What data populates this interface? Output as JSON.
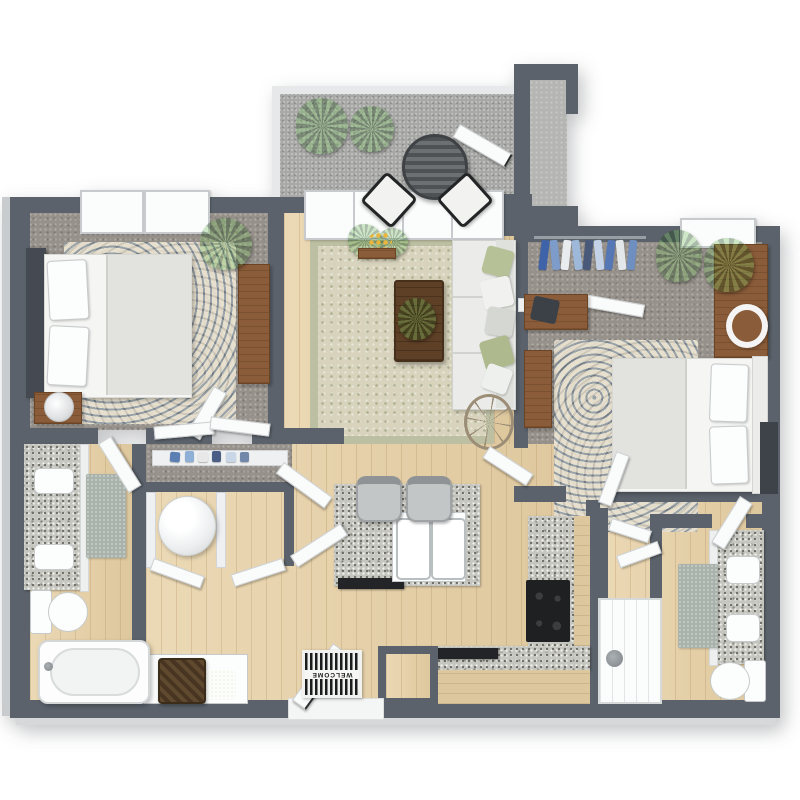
{
  "meta_description": "3D rendered top-down floor plan of a two-bedroom, two-bathroom apartment with balcony, open living room and kitchen",
  "welcome_mat": {
    "text": "WELCOME"
  },
  "colors": {
    "wall": "#5b626b",
    "wood_floor": "#e5d0a8",
    "carpet": "#97918b",
    "granite": "#c6c6c0",
    "cabinet_wood": "#dcc79e",
    "furniture_wood": "#8a5c39",
    "sofa": "#ebece9",
    "rug_sage": "#d7d3bc",
    "rug_blue": "#8fa2b3",
    "plant_green": "#3f7d33",
    "appliance_black": "#222427",
    "white_fixture": "#fcfdfd",
    "bath_mat": "#a9b2ab",
    "balcony_floor": "#a8a8a6",
    "mat_stripe_dark": "#1b1c1d"
  },
  "legend": {
    "rooms": [
      "balcony",
      "bedroom-1",
      "living-room",
      "bedroom-2",
      "hallway",
      "bathroom-1",
      "kitchen",
      "bathroom-2",
      "entry"
    ],
    "fixtures": [
      "patio-table",
      "patio-chairs",
      "planters",
      "bed",
      "nightstand-lamp",
      "dresser",
      "sofa",
      "coffee-table",
      "side-table",
      "kitchen-island",
      "double-sink",
      "bar-stools",
      "stove",
      "dishwasher",
      "washer",
      "vanity-sinks",
      "toilet",
      "bathtub",
      "shower",
      "welcome-mat",
      "closet-clothes"
    ]
  }
}
